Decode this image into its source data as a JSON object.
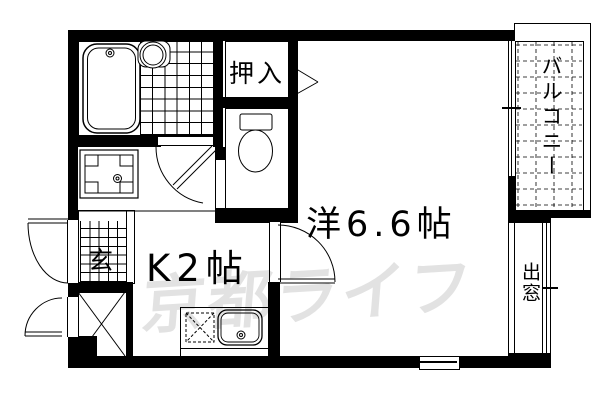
{
  "floorplan": {
    "rooms": {
      "closet": "押入",
      "balcony": "バルコニー",
      "western_room": "洋6.6帖",
      "kitchen": "K2帖",
      "entrance": "玄",
      "bay_window": "出窓"
    },
    "watermark": "京都ライフ",
    "colors": {
      "line": "#000000",
      "background": "#ffffff",
      "watermark": "#e2e2e2"
    }
  }
}
